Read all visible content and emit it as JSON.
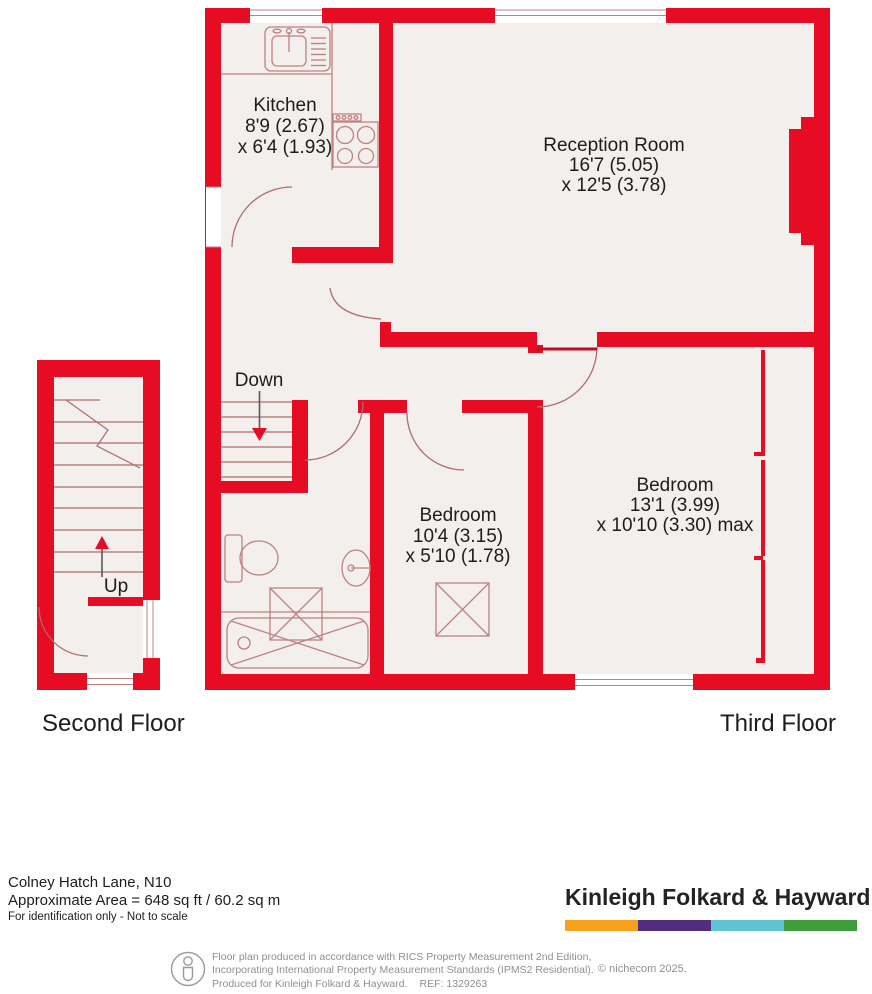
{
  "plan": {
    "third_floor": {
      "label": "Third Floor",
      "stairs_label": "Down",
      "rooms": {
        "kitchen": {
          "name": "Kitchen",
          "dim1": "8'9 (2.67)",
          "dim2": "x 6'4 (1.93)"
        },
        "reception": {
          "name": "Reception Room",
          "dim1": "16'7 (5.05)",
          "dim2": "x 12'5 (3.78)"
        },
        "bedroom_small": {
          "name": "Bedroom",
          "dim1": "10'4 (3.15)",
          "dim2": "x 5'10 (1.78)"
        },
        "bedroom_large": {
          "name": "Bedroom",
          "dim1": "13'1 (3.99)",
          "dim2": "x 10'10 (3.30) max"
        }
      }
    },
    "second_floor": {
      "label": "Second Floor",
      "stairs_label": "Up"
    }
  },
  "footer": {
    "address": "Colney Hatch Lane, N10",
    "area": "Approximate Area = 648 sq ft / 60.2 sq m",
    "scale_note": "For identification only - Not to scale",
    "brand": {
      "name": "Kinleigh Folkard & Hayward",
      "bar_colors": [
        "#F6A01B",
        "#522D7E",
        "#5FC3D2",
        "#3F9C3B"
      ]
    },
    "legal": {
      "line1": "Floor plan produced in accordance with RICS Property Measurement 2nd Edition,",
      "line2": "Incorporating International Property Measurement Standards (IPMS2 Residential).",
      "line3": "Produced for Kinleigh Folkard & Hayward.",
      "ref": "REF: 1329263",
      "copyright": "© nichecom 2025."
    }
  },
  "colors": {
    "wall": "#e60c24",
    "floor": "#f2efed",
    "fixture": "#c08080",
    "door": "#b06c6c",
    "window_line": "#c08080"
  }
}
